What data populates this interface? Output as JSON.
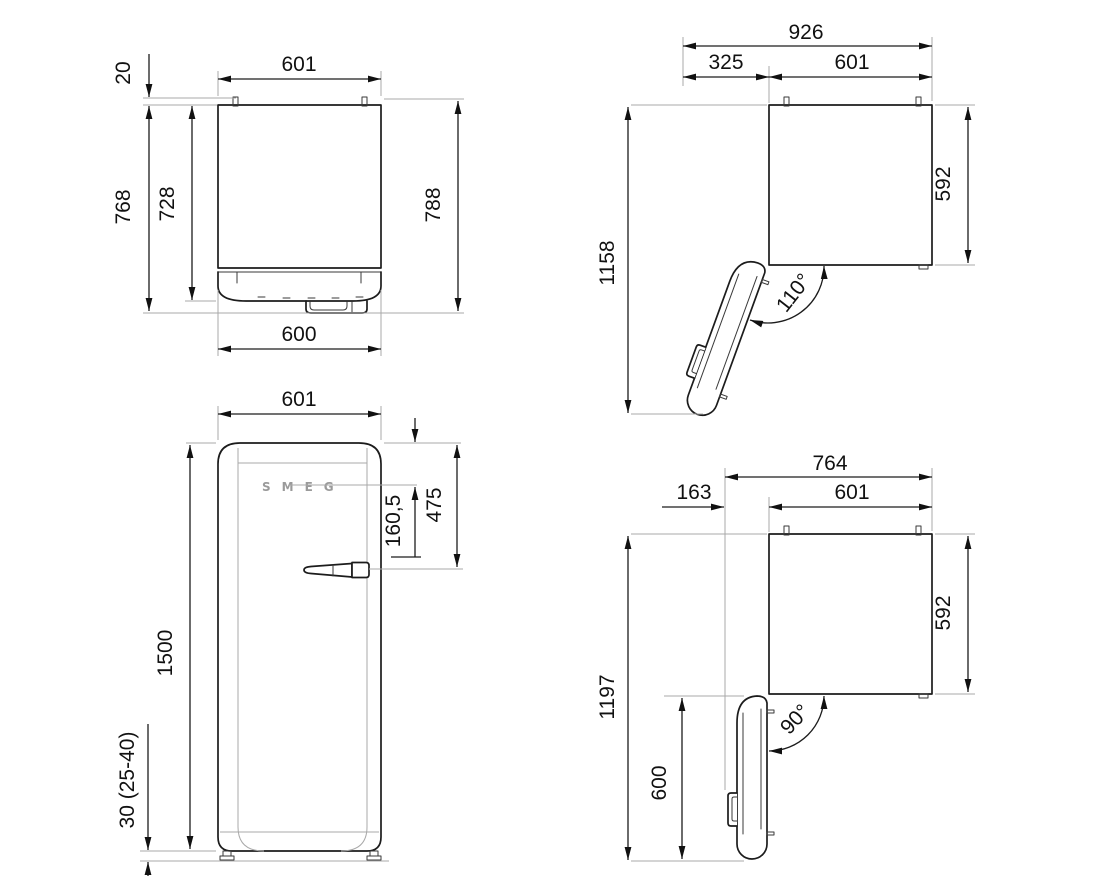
{
  "drawing": {
    "type": "appliance-dimension-drawing",
    "subject": "retro single-door refrigerator, four orthographic views",
    "units": "mm",
    "colors": {
      "line": "#1c1c1c",
      "extension_line": "#a8a8a8",
      "background": "#ffffff",
      "logo_gray": "#9a9a9a"
    }
  },
  "views": {
    "top_view_closed": {
      "name": "Top view, door closed",
      "dims": {
        "door_width_top": "601",
        "rear_spacer": "20",
        "depth_with_handle": "768",
        "depth_body": "728",
        "depth_total": "788",
        "door_width_bottom": "600"
      }
    },
    "top_view_open_110": {
      "name": "Top view, door open 110 degrees",
      "dims": {
        "total_width": "926",
        "door_clearance": "325",
        "cabinet_width": "601",
        "total_depth": "1158",
        "cabinet_depth": "592",
        "opening_angle": "110°"
      }
    },
    "front_view": {
      "name": "Front view",
      "logo": "SMEG",
      "dims": {
        "width": "601",
        "height": "1500",
        "top_to_logo": "160,5",
        "top_to_handle": "475",
        "feet_height": "30 (25-40)"
      }
    },
    "top_view_open_90": {
      "name": "Top view, door open 90 degrees",
      "dims": {
        "total_width": "764",
        "door_clearance": "163",
        "cabinet_width": "601",
        "total_depth": "1197",
        "cabinet_depth": "592",
        "door_open_depth": "600",
        "opening_angle": "90°"
      }
    }
  }
}
